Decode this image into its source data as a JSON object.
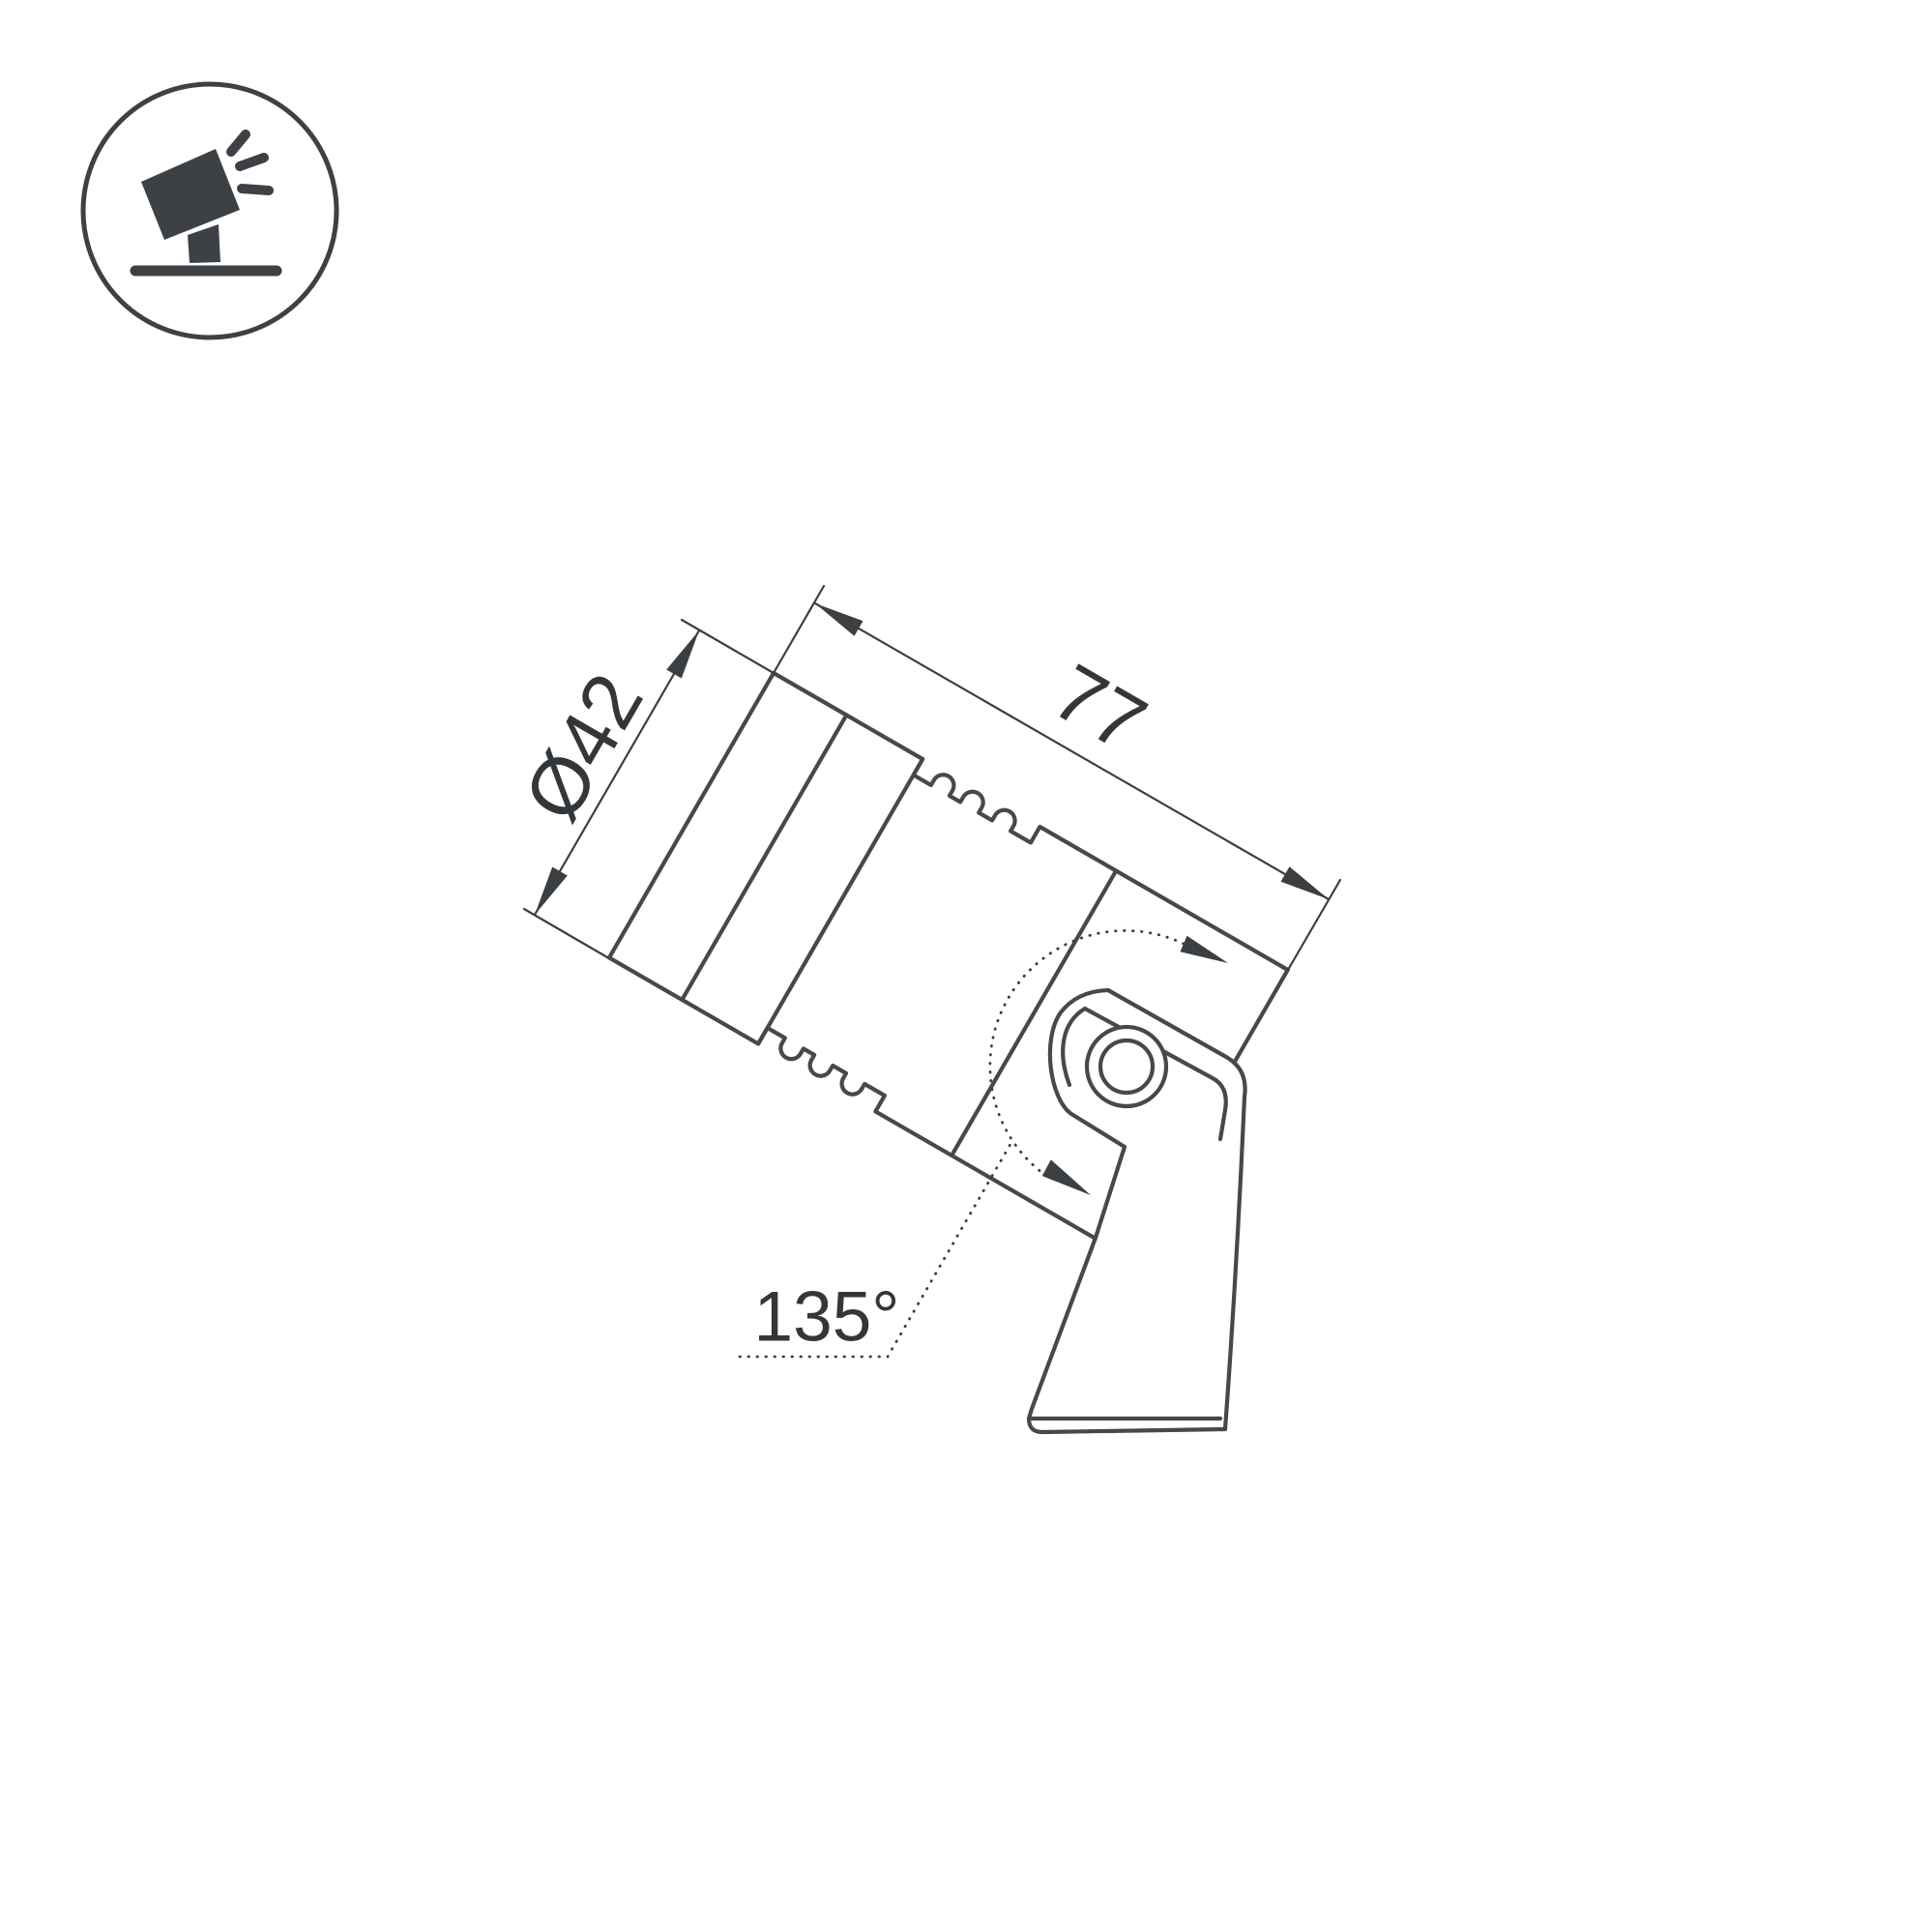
{
  "page": {
    "background": "#ffffff"
  },
  "badge_icon": {
    "name": "tilted-spotlight-on-ground-icon",
    "color": "#3d4145"
  },
  "drawing": {
    "stroke_color": "#46494c",
    "text_color": "#33373a",
    "product": "adjustable landscape spotlight side view",
    "dimensions": {
      "diameter_label": "Ø42",
      "length_label": "77",
      "tilt_angle_label": "135°"
    }
  }
}
